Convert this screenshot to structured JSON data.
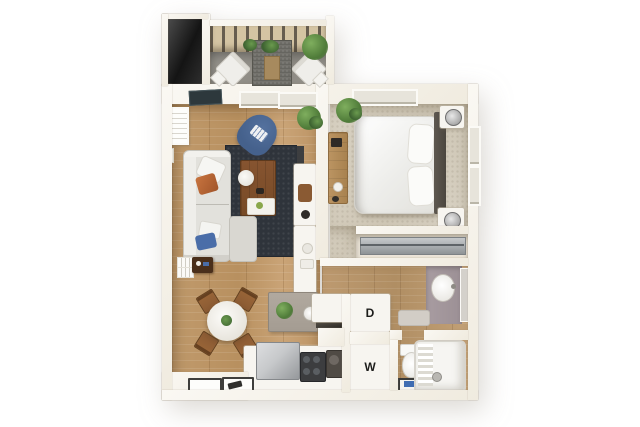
{
  "floorplan": {
    "labels": {
      "dryer": "D",
      "washer": "W"
    }
  },
  "colors": {
    "bg": "#ffffff",
    "wall": "#f5f2ea",
    "wood_floor": "#c09a6c",
    "carpet": "#d8d1c2",
    "balcony_floor": "#96938c",
    "rug": "#2f343b",
    "sofa": "#e2e1dc",
    "armchair": "#45618c",
    "coffee_table": "#774a26",
    "accent_wood": "#8a5a33",
    "island": "#a49c92",
    "vanity_counter": "#9c9095",
    "appliance_dark": "#3c3d3f",
    "appliance_silver": "#c7c9cb",
    "bath_mat": "#3f6cb2",
    "plant_green": "#4e7a3a",
    "label_text": "#1d1d1b"
  }
}
